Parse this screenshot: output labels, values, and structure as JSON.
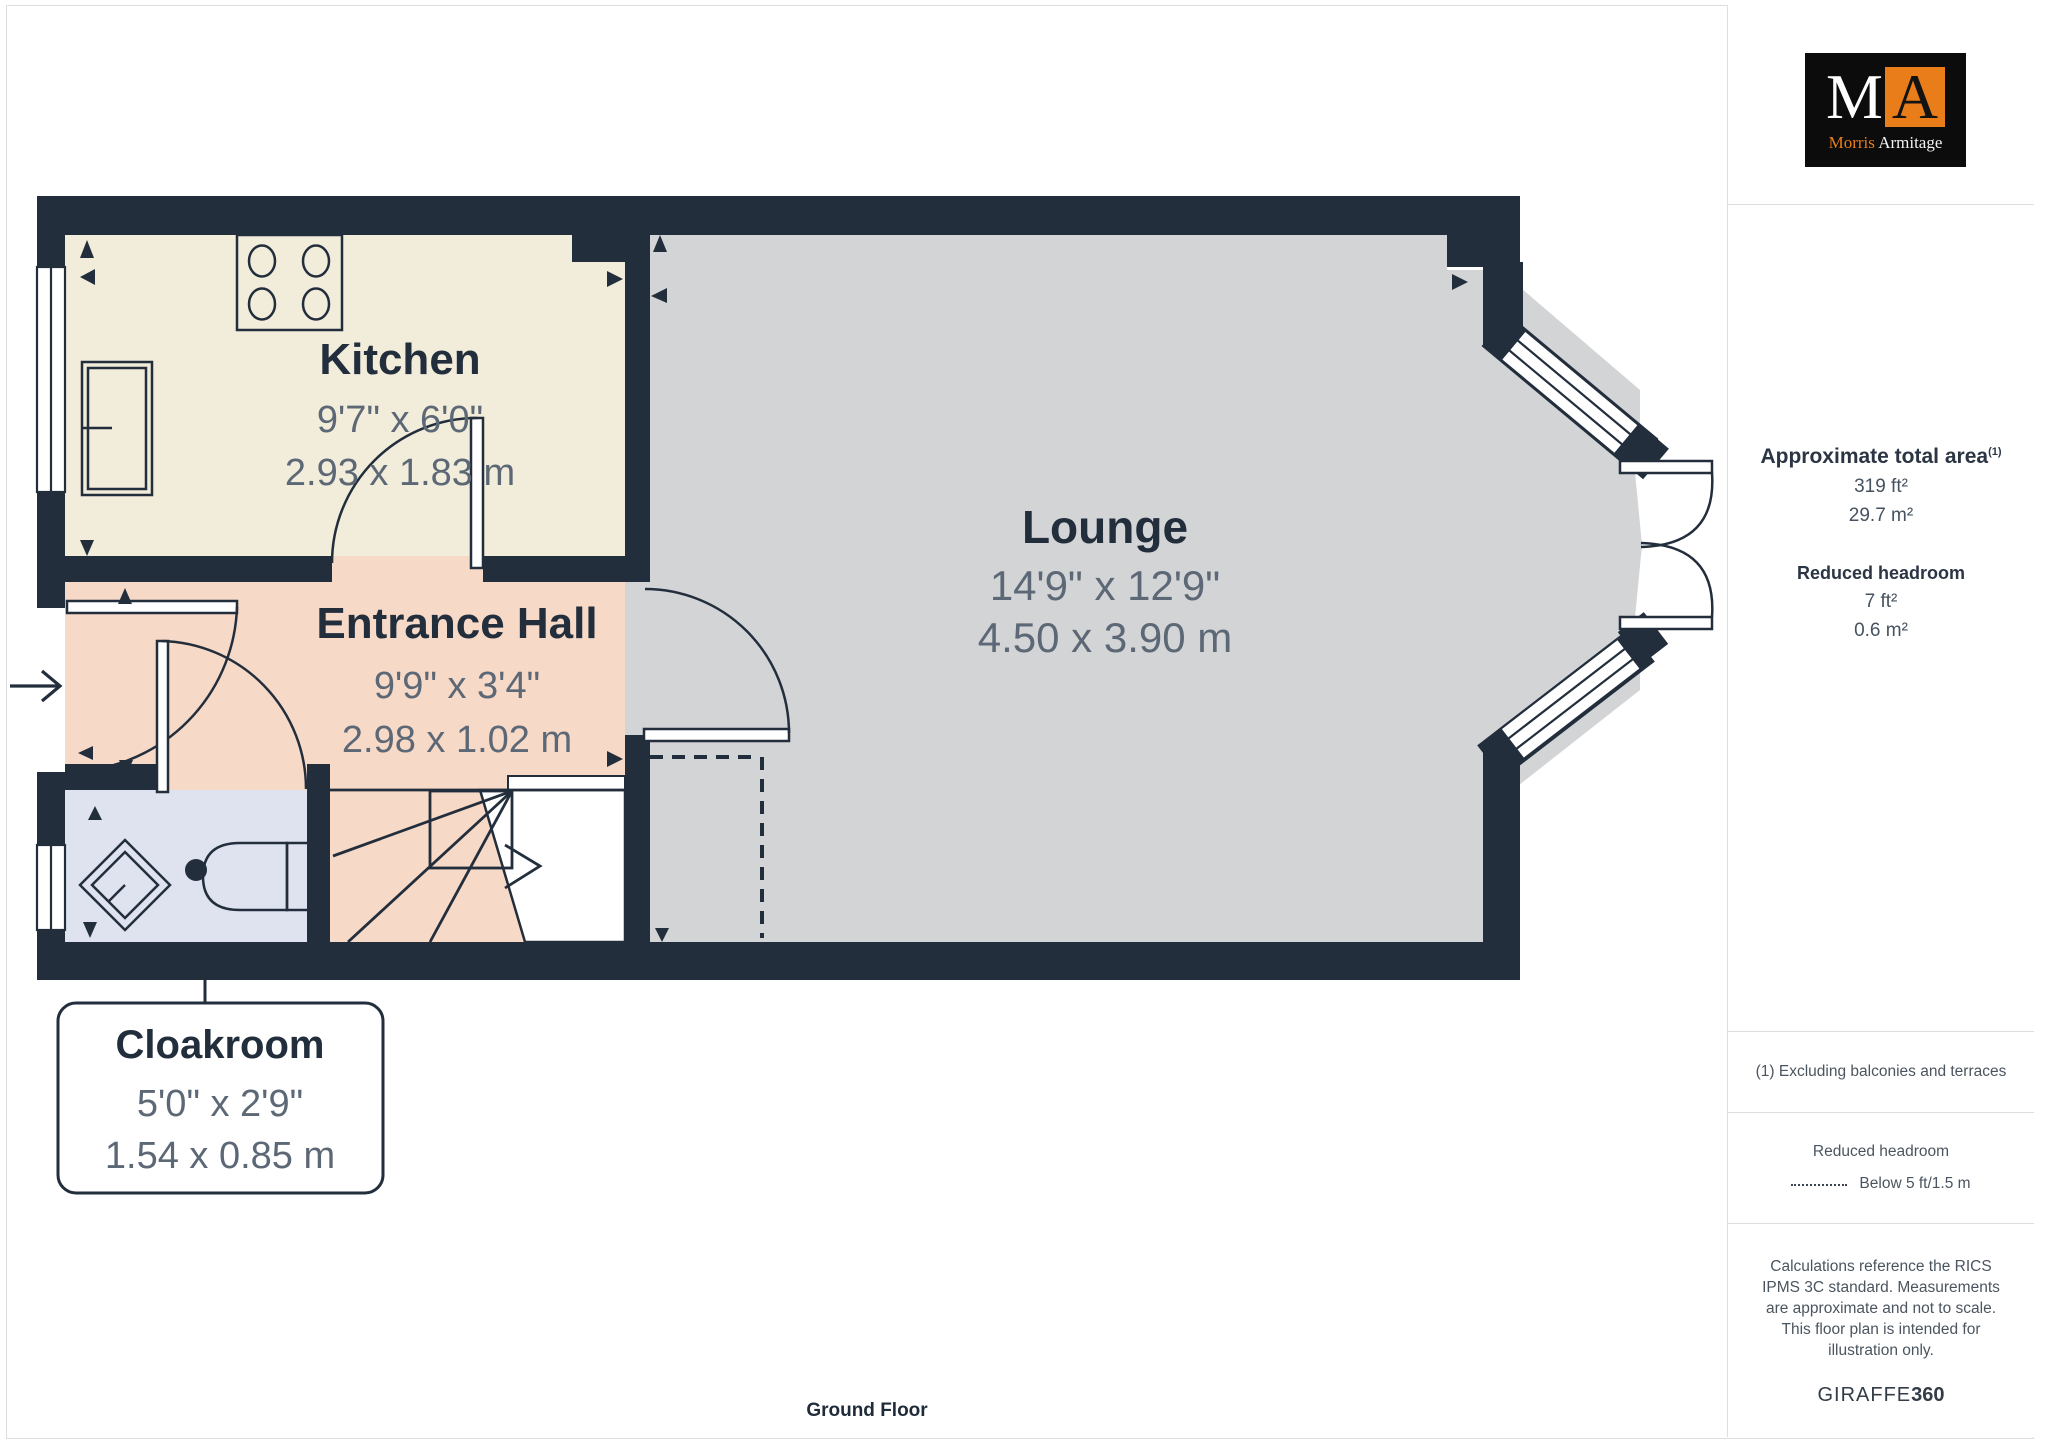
{
  "plan": {
    "floor_label": "Ground Floor",
    "rooms": [
      {
        "id": "kitchen",
        "name": "Kitchen",
        "dims_imperial": "9'7\" x 6'0\"",
        "dims_metric": "2.93 x 1.83 m"
      },
      {
        "id": "lounge",
        "name": "Lounge",
        "dims_imperial": "14'9\" x 12'9\"",
        "dims_metric": "4.50 x 3.90 m"
      },
      {
        "id": "entrance_hall",
        "name": "Entrance Hall",
        "dims_imperial": "9'9\" x 3'4\"",
        "dims_metric": "2.98 x 1.02 m"
      },
      {
        "id": "cloakroom",
        "name": "Cloakroom",
        "dims_imperial": "5'0\" x 2'9\"",
        "dims_metric": "1.54 x 0.85 m"
      }
    ]
  },
  "sidebar": {
    "logo": {
      "letter_m": "M",
      "letter_a": "A",
      "name_first": "Morris",
      "name_last": "Armitage"
    },
    "area": {
      "title": "Approximate total area",
      "superscript": "(1)",
      "value_imperial": "319 ft²",
      "value_metric": "29.7 m²",
      "reduced_title": "Reduced headroom",
      "reduced_imperial": "7 ft²",
      "reduced_metric": "0.6 m²"
    },
    "footnote": "(1) Excluding balconies and terraces",
    "legend": {
      "title": "Reduced headroom",
      "item": "Below 5 ft/1.5 m"
    },
    "disclaimer": "Calculations reference the RICS IPMS 3C standard. Measurements are approximate and not to scale. This floor plan is intended for illustration only.",
    "brand": {
      "name": "GIRAFFE",
      "suffix": "360"
    }
  },
  "colors": {
    "wall": "#232e3d",
    "kitchen_floor": "#f2ecda",
    "hall_floor": "#f7d9c7",
    "lounge_floor": "#d3d4d6",
    "cloakroom_floor": "#dfe3f0",
    "room_name_text": "#232e3d",
    "dims_text": "#5d6876",
    "logo_orange": "#e87d1a",
    "divider": "#dcdee1"
  }
}
